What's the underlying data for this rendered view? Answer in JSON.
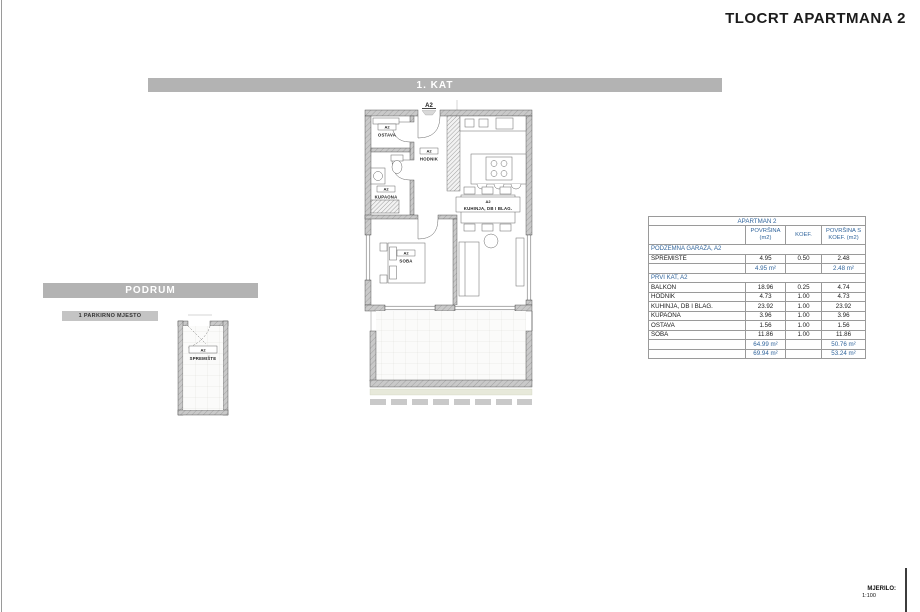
{
  "page": {
    "title": "TLOCRT APARTMANA 2",
    "scale_label": "MJERILO:",
    "scale_value": "1:100"
  },
  "bars": {
    "floor1": "1. KAT",
    "basement": "PODRUM",
    "parking": "1 PARKIRNO MJESTO"
  },
  "plan": {
    "entrance_label": "A2",
    "rooms": {
      "ostava": {
        "unit": "A2",
        "name": "OSTAVA"
      },
      "hodnik": {
        "unit": "A2",
        "name": "HODNIK"
      },
      "kupaona": {
        "unit": "A2",
        "name": "KUPAONA"
      },
      "soba": {
        "unit": "A2",
        "name": "SOBA"
      },
      "kuhinja": {
        "unit": "A2",
        "name": "KUHINJA, DB I BLAG."
      },
      "balkon": {
        "unit": "A2",
        "name": "BALKON"
      },
      "spremiste": {
        "unit": "A2",
        "name": "SPREMIŠTE"
      }
    }
  },
  "table": {
    "title": "APARTMAN 2",
    "columns": [
      "",
      "POVRŠINA\n(m2)",
      "KOEF.",
      "POVRŠINA S\nKOEF. (m2)"
    ],
    "sections": [
      {
        "header": "PODZEMNA GARAŽA, A2",
        "rows": [
          [
            "SPREMIŠTE",
            "4.95",
            "0.50",
            "2.48"
          ]
        ],
        "subtotal": [
          "4.95 m²",
          "",
          "2.48 m²"
        ]
      },
      {
        "header": "PRVI KAT, A2",
        "rows": [
          [
            "BALKON",
            "18.96",
            "0.25",
            "4.74"
          ],
          [
            "HODNIK",
            "4.73",
            "1.00",
            "4.73"
          ],
          [
            "KUHINJA, DB I BLAG.",
            "23.92",
            "1.00",
            "23.92"
          ],
          [
            "KUPAONA",
            "3.96",
            "1.00",
            "3.96"
          ],
          [
            "OSTAVA",
            "1.56",
            "1.00",
            "1.56"
          ],
          [
            "SOBA",
            "11.86",
            "1.00",
            "11.86"
          ]
        ],
        "subtotal": [
          "64.99 m²",
          "",
          "50.76 m²"
        ]
      }
    ],
    "total": [
      "69.94 m²",
      "",
      "53.24 m²"
    ]
  },
  "colors": {
    "accent_blue": "#31659c",
    "bar_gray": "#b3b3b3",
    "wall_gray": "#c9c9c9",
    "green_strip": "#e7e9da"
  }
}
